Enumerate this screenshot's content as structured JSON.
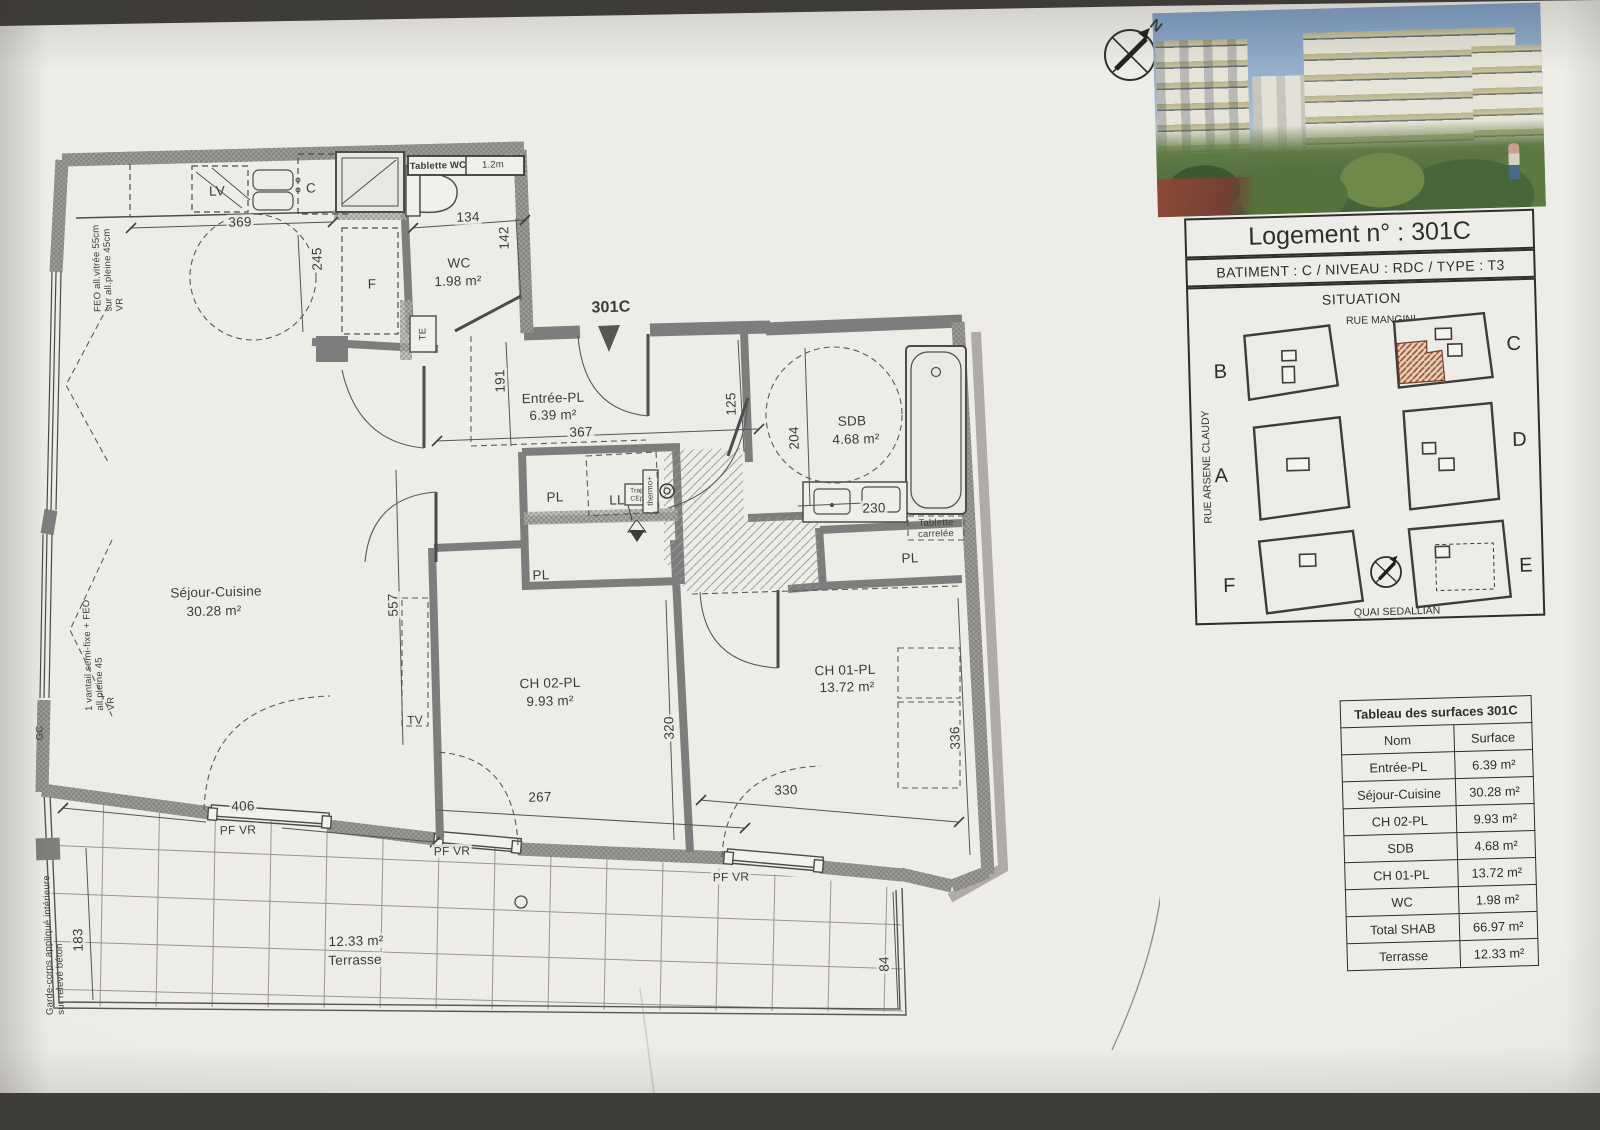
{
  "plan": {
    "marker": "301C",
    "compass_n": "N",
    "labels": {
      "pl": "PL",
      "pf_vr": "PF VR",
      "tv": "TV",
      "ll": "LL",
      "lv": "LV",
      "c": "C",
      "f": "F",
      "te": "TE",
      "gc": "GC"
    },
    "wc": {
      "tablette": "Tablette WC",
      "len": "1.2m",
      "name": "WC",
      "area": "1.98 m²"
    },
    "entree": {
      "name": "Entrée-PL",
      "area": "6.39 m²"
    },
    "sdb": {
      "name": "SDB",
      "area": "4.68 m²",
      "tablette1": "Tablette",
      "tablette2": "carrelée"
    },
    "sejour": {
      "name": "Séjour-Cuisine",
      "area": "30.28 m²"
    },
    "ch02": {
      "name": "CH 02-PL",
      "area": "9.93 m²"
    },
    "ch01": {
      "name": "CH 01-PL",
      "area": "13.72 m²"
    },
    "terrasse": {
      "name": "Terrasse",
      "area": "12.33 m²"
    },
    "laundry": {
      "trap1": "Trap",
      "trap2": "CEp",
      "thermo": "thermo+"
    },
    "notes": {
      "feo1": "FEO all.vitrée 55cm",
      "feo2": "sur all.pleine 45cm",
      "feo3": "VR",
      "van1": "1 vantail semi-fixe + FEO",
      "van2": "all.pleine 45",
      "van3": "VR",
      "garde1": "Garde-corps appliqué intérieure",
      "garde2": "sur relevé béton"
    },
    "dims": {
      "d369": "369",
      "d245": "245",
      "d134": "134",
      "d142": "142",
      "d191": "191",
      "d367": "367",
      "d125": "125",
      "d204": "204",
      "d230": "230",
      "d557": "557",
      "d320": "320",
      "d336": "336",
      "d267": "267",
      "d330": "330",
      "d406": "406",
      "d183": "183",
      "d84": "84"
    }
  },
  "panel": {
    "title": "Logement n° : 301C",
    "subtitle": "BATIMENT : C    /    NIVEAU : RDC    /    TYPE : T3",
    "situation": {
      "heading": "SITUATION",
      "street_top": "RUE MANGINI",
      "street_left": "RUE ARSENE CLAUDY",
      "street_bottom": "QUAI SEDALLIAN",
      "buildings": [
        "B",
        "C",
        "A",
        "D",
        "F",
        "E"
      ]
    },
    "table": {
      "title": "Tableau des surfaces 301C",
      "col_name": "Nom",
      "col_surface": "Surface",
      "rows": [
        {
          "name": "Entrée-PL",
          "surface": "6.39 m²"
        },
        {
          "name": "Séjour-Cuisine",
          "surface": "30.28 m²"
        },
        {
          "name": "CH 02-PL",
          "surface": "9.93 m²"
        },
        {
          "name": "SDB",
          "surface": "4.68 m²"
        },
        {
          "name": "CH 01-PL",
          "surface": "13.72 m²"
        },
        {
          "name": "WC",
          "surface": "1.98 m²"
        },
        {
          "name": "Total SHAB",
          "surface": "66.97 m²"
        },
        {
          "name": "Terrasse",
          "surface": "12.33 m²"
        }
      ]
    }
  }
}
